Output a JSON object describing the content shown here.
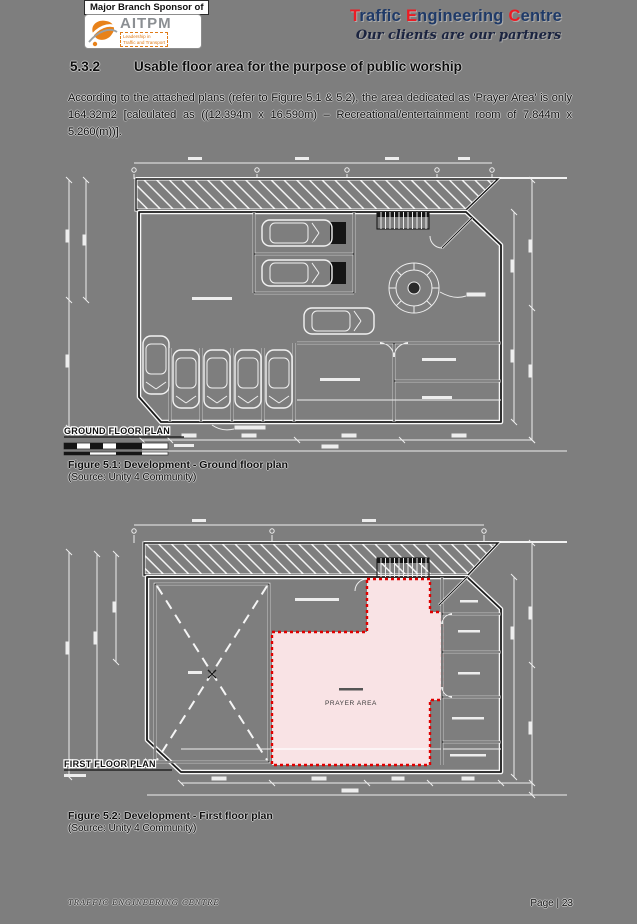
{
  "page": {
    "bg_color": "#7e7e7e",
    "footer": {
      "left": "TRAFFIC ENGINEERING CENTRE",
      "page": "Page | 23"
    }
  },
  "header": {
    "sponsor_text": "Major Branch Sponsor of",
    "logo": {
      "name": "AITPM",
      "tagline_line1": "Leadership in",
      "tagline_line2": "Traffic and Transport",
      "orange": "#e8821a",
      "gray": "#8b8f93"
    },
    "brand": {
      "words": [
        {
          "initial": "T",
          "rest": "raffic"
        },
        {
          "initial": "E",
          "rest": "ngineering"
        },
        {
          "initial": "C",
          "rest": "entre"
        }
      ],
      "tagline": "Our clients are our partners",
      "red": "#ec1c24",
      "navy": "#1f3a68"
    },
    "icons": {
      "logo_emblem": "aitpm-swoosh-emblem"
    }
  },
  "section": {
    "number": "5.3.2",
    "title": "Usable floor area for the purpose of public worship",
    "body": "According to the attached plans (refer to Figure 5.1 & 5.2), the area dedicated as 'Prayer Area' is only 164.32m2 [calculated as ((12.394m x 16.590m) – Recreational/entertainment room of 7.844m x 5.260(m))]."
  },
  "figures": {
    "ground": {
      "plan_title": "GROUND FLOOR PLAN",
      "caption": "Figure 5.1: Development - Ground floor plan",
      "source": "(Source: Unity 4 Community)"
    },
    "first": {
      "plan_title": "FIRST FLOOR PLAN",
      "caption": "Figure 5.2: Development - First floor plan",
      "source": "(Source: Unity 4 Community)",
      "prayer_label": "PRAYER AREA",
      "prayer_fill": "#f9e3e5",
      "prayer_border": "#e00000"
    }
  }
}
